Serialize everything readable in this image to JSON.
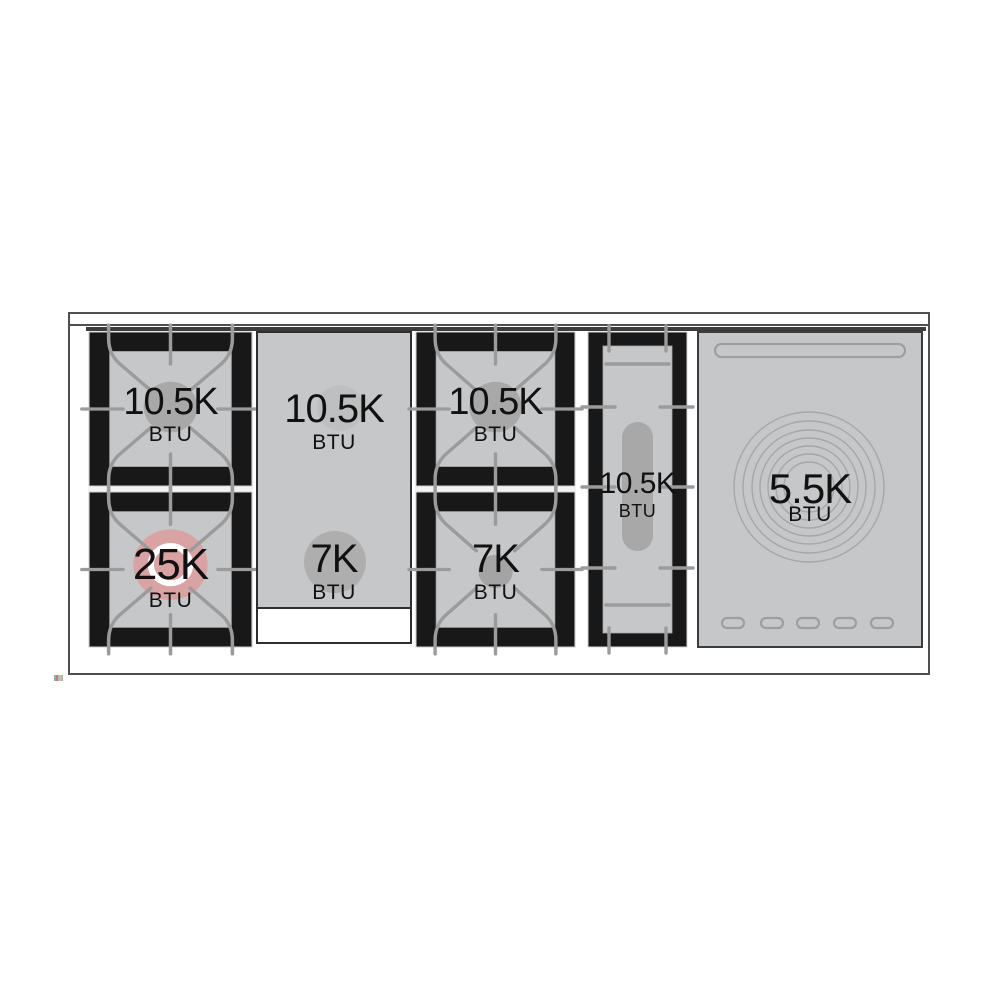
{
  "colors": {
    "surface_gray": "#c6c7c8",
    "frame_black": "#181818",
    "grate_gray": "#9b9b9b",
    "trim_dark": "#3c3c3c",
    "outline_gray": "#4f4f4f",
    "burner_cap_gray": "#a8a8a9",
    "power_burner_pink": "#d9a3a4",
    "griddle_spot_light": "#bebfc0",
    "griddle_spot_dark": "#aeaeaf",
    "text_black": "#111111"
  },
  "sections": {
    "left_burner_unit": {
      "top_burner": {
        "value": "10.5K",
        "unit": "BTU"
      },
      "bottom_burner": {
        "value": "25K",
        "unit": "BTU"
      }
    },
    "griddle": {
      "top_burner": {
        "value": "10.5K",
        "unit": "BTU"
      },
      "bottom_burner": {
        "value": "7K",
        "unit": "BTU"
      }
    },
    "center_burner_unit": {
      "top_burner": {
        "value": "10.5K",
        "unit": "BTU"
      },
      "bottom_burner": {
        "value": "7K",
        "unit": "BTU"
      }
    },
    "oval_burner_unit": {
      "burner": {
        "value": "10.5K",
        "unit": "BTU"
      }
    },
    "french_top": {
      "burner": {
        "value": "5.5K",
        "unit": "BTU"
      }
    }
  }
}
